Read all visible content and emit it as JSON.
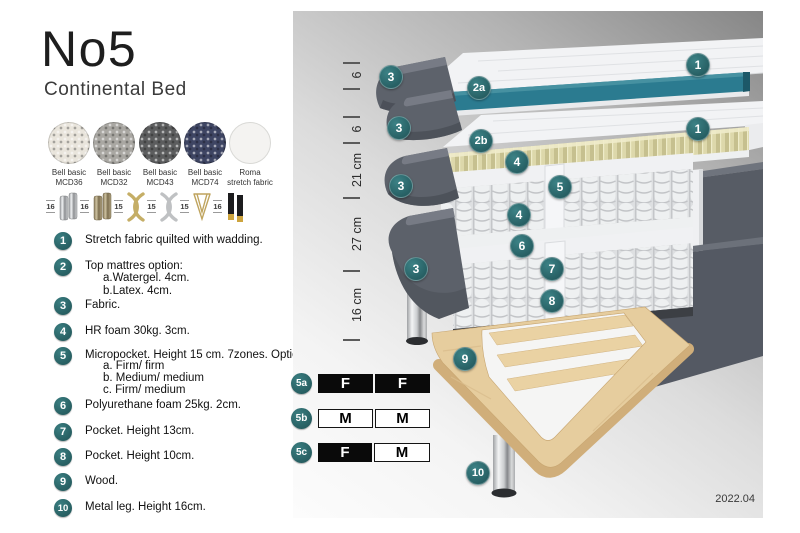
{
  "header": {
    "title": "No5",
    "subtitle": "Continental Bed"
  },
  "fabrics": [
    {
      "name": "Bell basic",
      "code": "MCD36",
      "color": "#e9e5dc"
    },
    {
      "name": "Bell basic",
      "code": "MCD32",
      "color": "#a9a7a2"
    },
    {
      "name": "Bell basic",
      "code": "MCD43",
      "color": "#5c5d5e"
    },
    {
      "name": "Bell basic",
      "code": "MCD74",
      "color": "#3e4563"
    },
    {
      "name": "Roma",
      "code": "stretch fabric",
      "color": "#f4f3f1"
    }
  ],
  "leg_options": [
    {
      "height": "16",
      "style": "cylinder-chrome"
    },
    {
      "height": "16",
      "style": "cylinder-bronze"
    },
    {
      "height": "15",
      "style": "twist-gold"
    },
    {
      "height": "15",
      "style": "twist-silver"
    },
    {
      "height": "15",
      "style": "hairpin-gold"
    },
    {
      "height": "16",
      "style": "tapered-black-gold"
    }
  ],
  "parts": [
    {
      "num": "1",
      "text": "Stretch fabric quilted with wadding.",
      "sub": []
    },
    {
      "num": "2",
      "text": "Top mattres option:",
      "sub": [
        "a.Watergel. 4cm.",
        "b.Latex. 4cm."
      ]
    },
    {
      "num": "3",
      "text": "Fabric.",
      "sub": []
    },
    {
      "num": "4",
      "text": "HR foam 30kg. 3cm.",
      "sub": []
    },
    {
      "num": "5",
      "text": "Micropocket. Height 15 cm. 7zones. Option:",
      "sub": [
        "a. Firm/ firm",
        "b. Medium/ medium",
        "c. Firm/ medium"
      ]
    },
    {
      "num": "6",
      "text": "Polyurethane foam 25kg. 2cm.",
      "sub": []
    },
    {
      "num": "7",
      "text": "Pocket. Height 13cm.",
      "sub": []
    },
    {
      "num": "8",
      "text": "Pocket. Height 10cm.",
      "sub": []
    },
    {
      "num": "9",
      "text": "Wood.",
      "sub": []
    },
    {
      "num": "10",
      "text": "Metal leg. Height 16cm.",
      "sub": []
    }
  ],
  "diagram": {
    "ruler_labels": [
      "6",
      "6",
      "21 cm",
      "27 cm",
      "16 cm"
    ],
    "callouts": [
      "1",
      "3",
      "2a",
      "3",
      "2b",
      "1",
      "4",
      "3",
      "5",
      "4",
      "6",
      "3",
      "7",
      "8",
      "9",
      "10"
    ],
    "firmness_rows": [
      {
        "label": "5a",
        "cells": [
          {
            "text": "F",
            "variant": "dark"
          },
          {
            "text": "F",
            "variant": "dark"
          }
        ]
      },
      {
        "label": "5b",
        "cells": [
          {
            "text": "M",
            "variant": "light"
          },
          {
            "text": "M",
            "variant": "light"
          }
        ]
      },
      {
        "label": "5c",
        "cells": [
          {
            "text": "F",
            "variant": "dark"
          },
          {
            "text": "M",
            "variant": "light"
          }
        ]
      }
    ],
    "version": "2022.04",
    "colors": {
      "accent_teal": "#2e6d70",
      "topper_teal": "#2b7b90",
      "fabric_grey": "#5d626b",
      "latex_khaki": "#d8d3a6",
      "wood": "#e6cd9e"
    }
  }
}
